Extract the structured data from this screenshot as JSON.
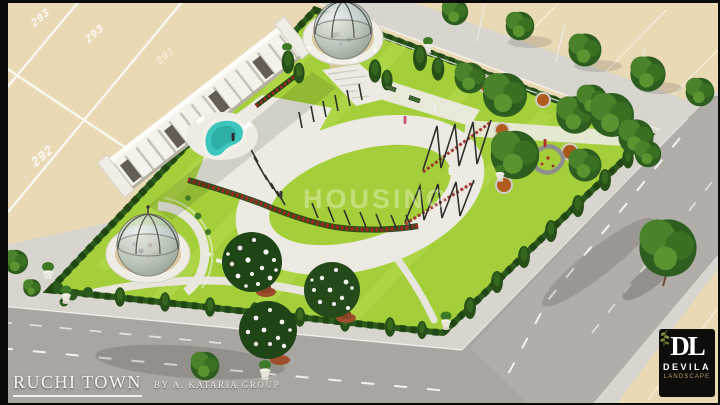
{
  "branding": {
    "title": "RUCHI TOWN",
    "subtitle": "BY A. KATARIA GROUP"
  },
  "watermark": "HOUSING",
  "plots": {
    "numbers": [
      "293",
      "293",
      "291",
      "292"
    ]
  },
  "logo": {
    "monogram": "DL",
    "name": "DEVILA",
    "tagline": "LANDSCAPE"
  },
  "colors": {
    "plot": "#ead9b5",
    "road": "#a9a5a0",
    "sidewalk": "#d8d5ce",
    "lawn": "#a4cf3a",
    "lawn_light": "#c8e664",
    "hedge": "#2c5a1d",
    "hedge_dark": "#1e4312",
    "path": "#eceae2",
    "pool": "#3cc6be",
    "building": "#f4f2eb",
    "red_flowers": "#9c2a24",
    "orange_flowers": "#b05c1f",
    "tree_dark": "#2e5e1f",
    "tree_mid": "#49822a",
    "pot": "#9c4f2a",
    "logo_bg": "#0d0d0c",
    "logo_gold": "#c99a5e"
  }
}
